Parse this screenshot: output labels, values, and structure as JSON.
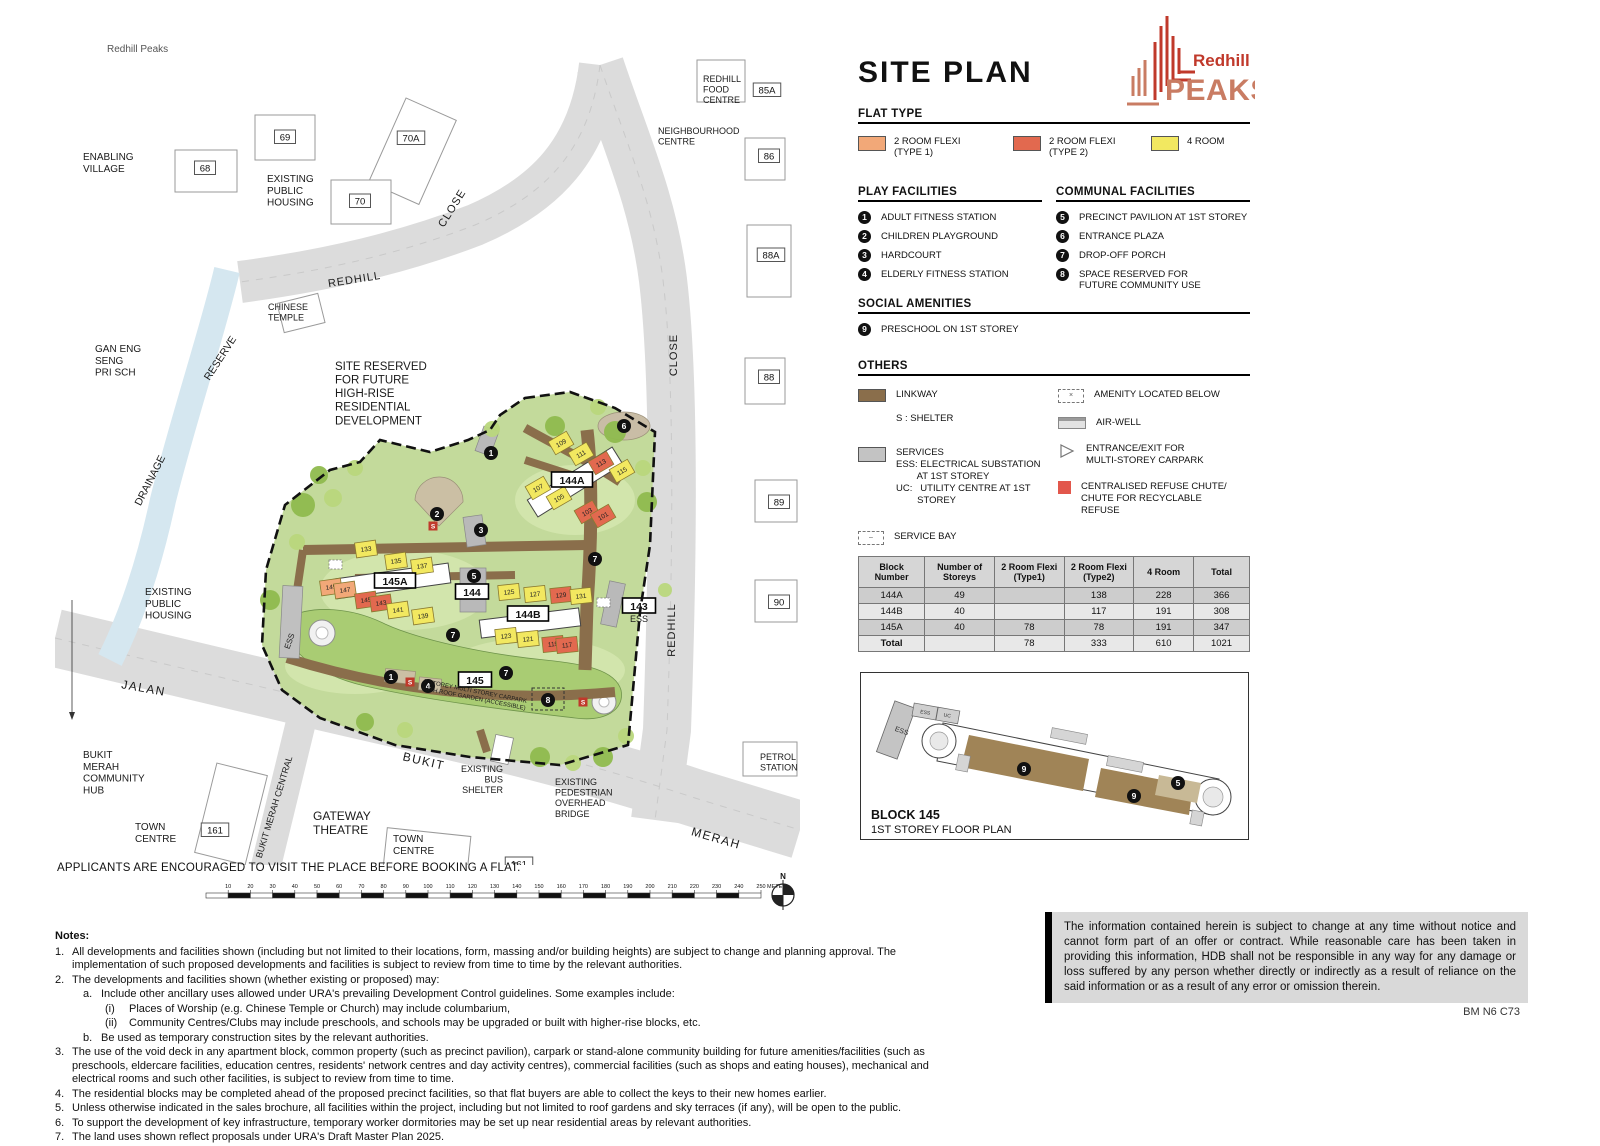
{
  "header": {
    "title": "SITE PLAN",
    "logo_top": "Redhill",
    "logo_bottom": "PEAKS",
    "logo_colors": {
      "red": "#C0392B",
      "salmon": "#C97C63"
    }
  },
  "flat_type": {
    "title": "FLAT TYPE",
    "items": [
      {
        "label": "2 ROOM FLEXI\n(TYPE 1)",
        "color": "#F2A878"
      },
      {
        "label": "2 ROOM FLEXI\n(TYPE 2)",
        "color": "#E2694F"
      },
      {
        "label": "4 ROOM",
        "color": "#F2E860"
      }
    ]
  },
  "play_facilities": {
    "title": "PLAY FACILITIES",
    "items": [
      {
        "num": "1",
        "label": "ADULT FITNESS STATION"
      },
      {
        "num": "2",
        "label": "CHILDREN PLAYGROUND"
      },
      {
        "num": "3",
        "label": "HARDCOURT"
      },
      {
        "num": "4",
        "label": "ELDERLY FITNESS STATION"
      }
    ]
  },
  "communal_facilities": {
    "title": "COMMUNAL FACILITIES",
    "items": [
      {
        "num": "5",
        "label": "PRECINCT PAVILION AT 1ST STOREY"
      },
      {
        "num": "6",
        "label": "ENTRANCE PLAZA"
      },
      {
        "num": "7",
        "label": "DROP-OFF PORCH"
      },
      {
        "num": "8",
        "label": "SPACE RESERVED FOR\nFUTURE COMMUNITY USE"
      }
    ]
  },
  "social_amenities": {
    "title": "SOCIAL AMENITIES",
    "items": [
      {
        "num": "9",
        "label": "PRESCHOOL ON 1ST STOREY"
      }
    ]
  },
  "others": {
    "title": "OTHERS",
    "linkway_label": "LINKWAY",
    "shelter_note": "S : SHELTER",
    "services_label": "SERVICES",
    "services_note": "ESS: ELECTRICAL SUBSTATION\n        AT 1ST STOREY\nUC:   UTILITY CENTRE AT 1ST\n        STOREY",
    "service_bay_label": "SERVICE BAY",
    "amenity_below_label": "AMENITY LOCATED BELOW",
    "air_well_label": "AIR-WELL",
    "carpark_entrance_label": "ENTRANCE/EXIT FOR\nMULTI-STOREY CARPARK",
    "refuse_label": "CENTRALISED REFUSE CHUTE/\nCHUTE FOR RECYCLABLE\nREFUSE",
    "colors": {
      "linkway": "#8A6E4B",
      "services": "#C3C3C3",
      "air_well": "#DFDFDF",
      "refuse": "#E2574C"
    }
  },
  "units_table": {
    "headers": [
      "Block\nNumber",
      "Number of\nStoreys",
      "2 Room Flexi\n(Type1)",
      "2 Room Flexi\n(Type2)",
      "4 Room",
      "Total"
    ],
    "rows": [
      [
        "144A",
        "49",
        "",
        "138",
        "228",
        "366"
      ],
      [
        "144B",
        "40",
        "",
        "117",
        "191",
        "308"
      ],
      [
        "145A",
        "40",
        "78",
        "78",
        "191",
        "347"
      ],
      [
        "Total",
        "",
        "78",
        "333",
        "610",
        "1021"
      ]
    ]
  },
  "floorplan": {
    "title": "BLOCK  145",
    "subtitle": "1ST STOREY FLOOR PLAN",
    "badges": [
      {
        "t": "9",
        "x": 163,
        "y": 96
      },
      {
        "t": "9",
        "x": 273,
        "y": 123
      },
      {
        "t": "5",
        "x": 317,
        "y": 110
      }
    ],
    "area_labels": [
      {
        "t": "ESS",
        "x": 40,
        "y": 60,
        "r": 20,
        "s": 7
      },
      {
        "t": "ESS",
        "x": 64,
        "y": 41,
        "r": 10,
        "s": 5
      },
      {
        "t": "UC",
        "x": 86,
        "y": 44,
        "r": 10,
        "s": 5
      }
    ]
  },
  "map": {
    "labels": [
      {
        "t": "Redhill Peaks",
        "x": 52,
        "y": 22,
        "s": 10,
        "c": "#555"
      },
      {
        "t": "ENABLING\nVILLAGE",
        "x": 28,
        "y": 130,
        "s": 10
      },
      {
        "t": "EXISTING\nPUBLIC\nHOUSING",
        "x": 212,
        "y": 152,
        "s": 10
      },
      {
        "t": "CHINESE\nTEMPLE",
        "x": 213,
        "y": 280,
        "s": 9
      },
      {
        "t": "GAN ENG\nSENG\nPRI SCH",
        "x": 40,
        "y": 322,
        "s": 10
      },
      {
        "t": "RESERVE",
        "x": 168,
        "y": 330,
        "s": 10.5,
        "r": -57,
        "a": "m"
      },
      {
        "t": "DRAINAGE",
        "x": 98,
        "y": 452,
        "s": 10.5,
        "r": -63,
        "a": "m"
      },
      {
        "t": "REDHILL",
        "x": 300,
        "y": 253,
        "s": 11,
        "r": -9,
        "a": "m",
        "ls": 1
      },
      {
        "t": "CLOSE",
        "x": 400,
        "y": 180,
        "s": 11,
        "r": -58,
        "a": "m",
        "ls": 1
      },
      {
        "t": "CLOSE",
        "x": 622,
        "y": 325,
        "s": 11,
        "r": -90,
        "a": "m",
        "ls": 1
      },
      {
        "t": "REDHILL",
        "x": 620,
        "y": 600,
        "s": 11,
        "r": -90,
        "a": "m",
        "ls": 1
      },
      {
        "t": "JALAN",
        "x": 88,
        "y": 662,
        "s": 12,
        "r": 10,
        "a": "m",
        "ls": 1.5
      },
      {
        "t": "BUKIT",
        "x": 368,
        "y": 735,
        "s": 12,
        "r": 13,
        "a": "m",
        "ls": 1.5
      },
      {
        "t": "MERAH",
        "x": 660,
        "y": 812,
        "s": 12,
        "r": 16,
        "a": "m",
        "ls": 1.5
      },
      {
        "t": "BUKIT MERAH CENTRAL",
        "x": 222,
        "y": 778,
        "s": 9,
        "r": -73,
        "a": "m"
      },
      {
        "t": "SITE RESERVED\nFOR  FUTURE\nHIGH-RISE\nRESIDENTIAL\nDEVELOPMENT",
        "x": 280,
        "y": 340,
        "s": 11.5
      },
      {
        "t": "REDHILL\nFOOD\nCENTRE",
        "x": 648,
        "y": 52,
        "s": 9
      },
      {
        "t": "NEIGHBOURHOOD\nCENTRE",
        "x": 603,
        "y": 104,
        "s": 9
      },
      {
        "t": "PETROL\nSTATION",
        "x": 705,
        "y": 730,
        "s": 9
      },
      {
        "t": "BUKIT\nMERAH\nCOMMUNITY\nHUB",
        "x": 28,
        "y": 728,
        "s": 10
      },
      {
        "t": "TOWN\nCENTRE",
        "x": 80,
        "y": 800,
        "s": 10
      },
      {
        "t": "TOWN\nCENTRE",
        "x": 338,
        "y": 812,
        "s": 10
      },
      {
        "t": "GATEWAY\nTHEATRE",
        "x": 258,
        "y": 790,
        "s": 12
      },
      {
        "t": "EXISTING\nBUS\nSHELTER",
        "x": 448,
        "y": 742,
        "s": 9,
        "a": "e"
      },
      {
        "t": "EXISTING\nPEDESTRIAN\nOVERHEAD\nBRIDGE",
        "x": 500,
        "y": 755,
        "s": 9
      },
      {
        "t": "EXISTING\nPUBLIC\nHOUSING",
        "x": 90,
        "y": 565,
        "s": 10
      },
      {
        "t": "7 STOREY MULTI STOREY CARPARK\nWITH ROOF GARDEN (ACCESSIBLE)",
        "x": 420,
        "y": 663,
        "s": 6,
        "r": 11,
        "a": "m"
      },
      {
        "t": "ESS",
        "x": 237,
        "y": 612,
        "s": 8,
        "r": -70,
        "a": "m"
      },
      {
        "t": "ESS",
        "x": 584,
        "y": 592,
        "s": 9,
        "a": "m"
      }
    ],
    "number_boxes": [
      {
        "t": "68",
        "x": 150,
        "y": 138
      },
      {
        "t": "69",
        "x": 230,
        "y": 107
      },
      {
        "t": "70A",
        "x": 356,
        "y": 108
      },
      {
        "t": "70",
        "x": 305,
        "y": 171
      },
      {
        "t": "85A",
        "x": 712,
        "y": 60
      },
      {
        "t": "86",
        "x": 714,
        "y": 126
      },
      {
        "t": "88A",
        "x": 716,
        "y": 225
      },
      {
        "t": "88",
        "x": 714,
        "y": 347
      },
      {
        "t": "89",
        "x": 724,
        "y": 472
      },
      {
        "t": "90",
        "x": 724,
        "y": 572
      },
      {
        "t": "161",
        "x": 160,
        "y": 800
      },
      {
        "t": "161",
        "x": 464,
        "y": 834
      }
    ],
    "block_boxes": [
      {
        "t": "144A",
        "x": 517,
        "y": 450
      },
      {
        "t": "145A",
        "x": 340,
        "y": 551
      },
      {
        "t": "144B",
        "x": 473,
        "y": 584
      },
      {
        "t": "144",
        "x": 417,
        "y": 562
      },
      {
        "t": "145",
        "x": 420,
        "y": 650
      },
      {
        "t": "143",
        "x": 584,
        "y": 576
      }
    ],
    "units": [
      {
        "t": "109",
        "x": 506,
        "y": 413,
        "r": -30,
        "c": "y"
      },
      {
        "t": "111",
        "x": 526,
        "y": 424,
        "r": -30,
        "c": "y"
      },
      {
        "t": "113",
        "x": 546,
        "y": 433,
        "r": -30,
        "c": "r"
      },
      {
        "t": "115",
        "x": 567,
        "y": 441,
        "r": -30,
        "c": "y"
      },
      {
        "t": "107",
        "x": 483,
        "y": 458,
        "r": -30,
        "c": "y"
      },
      {
        "t": "105",
        "x": 504,
        "y": 468,
        "r": -30,
        "c": "y"
      },
      {
        "t": "103",
        "x": 532,
        "y": 482,
        "r": -30,
        "c": "r"
      },
      {
        "t": "101",
        "x": 548,
        "y": 486,
        "r": -30,
        "c": "r"
      },
      {
        "t": "133",
        "x": 311,
        "y": 519,
        "r": -8,
        "c": "y"
      },
      {
        "t": "135",
        "x": 341,
        "y": 531,
        "r": -8,
        "c": "y"
      },
      {
        "t": "137",
        "x": 367,
        "y": 536,
        "r": -8,
        "c": "y"
      },
      {
        "t": "149",
        "x": 276,
        "y": 557,
        "r": -8,
        "c": "o"
      },
      {
        "t": "147",
        "x": 290,
        "y": 560,
        "r": -8,
        "c": "o"
      },
      {
        "t": "145",
        "x": 311,
        "y": 570,
        "r": -8,
        "c": "r"
      },
      {
        "t": "143",
        "x": 326,
        "y": 573,
        "r": -8,
        "c": "r"
      },
      {
        "t": "141",
        "x": 343,
        "y": 580,
        "r": -8,
        "c": "y"
      },
      {
        "t": "139",
        "x": 368,
        "y": 586,
        "r": -8,
        "c": "y"
      },
      {
        "t": "125",
        "x": 454,
        "y": 562,
        "r": -6,
        "c": "y"
      },
      {
        "t": "127",
        "x": 480,
        "y": 564,
        "r": -6,
        "c": "y"
      },
      {
        "t": "129",
        "x": 506,
        "y": 565,
        "r": -6,
        "c": "r"
      },
      {
        "t": "131",
        "x": 526,
        "y": 566,
        "r": -6,
        "c": "y"
      },
      {
        "t": "123",
        "x": 451,
        "y": 606,
        "r": -6,
        "c": "y"
      },
      {
        "t": "121",
        "x": 473,
        "y": 609,
        "r": -6,
        "c": "y"
      },
      {
        "t": "119",
        "x": 498,
        "y": 614,
        "r": -6,
        "c": "r"
      },
      {
        "t": "117",
        "x": 512,
        "y": 615,
        "r": -6,
        "c": "r"
      }
    ],
    "badges": [
      {
        "t": "1",
        "x": 436,
        "y": 423
      },
      {
        "t": "2",
        "x": 382,
        "y": 484
      },
      {
        "t": "3",
        "x": 426,
        "y": 500
      },
      {
        "t": "5",
        "x": 419,
        "y": 546
      },
      {
        "t": "6",
        "x": 569,
        "y": 396
      },
      {
        "t": "7",
        "x": 540,
        "y": 529
      },
      {
        "t": "7",
        "x": 398,
        "y": 605
      },
      {
        "t": "7",
        "x": 451,
        "y": 643
      },
      {
        "t": "1",
        "x": 336,
        "y": 647
      },
      {
        "t": "4",
        "x": 373,
        "y": 656
      },
      {
        "t": "8",
        "x": 493,
        "y": 670
      }
    ],
    "shelters": [
      {
        "x": 378,
        "y": 496
      },
      {
        "x": 355,
        "y": 652
      },
      {
        "x": 528,
        "y": 672
      }
    ],
    "trees": [
      {
        "x": 248,
        "y": 475,
        "r": 12,
        "sh": "d"
      },
      {
        "x": 278,
        "y": 468,
        "r": 9,
        "sh": "l"
      },
      {
        "x": 560,
        "y": 402,
        "r": 11,
        "sh": "d"
      },
      {
        "x": 588,
        "y": 438,
        "r": 8,
        "sh": "l"
      },
      {
        "x": 592,
        "y": 472,
        "r": 10,
        "sh": "d"
      },
      {
        "x": 242,
        "y": 512,
        "r": 8,
        "sh": "l"
      },
      {
        "x": 215,
        "y": 570,
        "r": 10,
        "sh": "d"
      },
      {
        "x": 485,
        "y": 727,
        "r": 10,
        "sh": "d"
      },
      {
        "x": 518,
        "y": 733,
        "r": 8,
        "sh": "l"
      },
      {
        "x": 548,
        "y": 727,
        "r": 10,
        "sh": "d"
      },
      {
        "x": 571,
        "y": 706,
        "r": 8,
        "sh": "l"
      },
      {
        "x": 437,
        "y": 399,
        "r": 8,
        "sh": "l"
      },
      {
        "x": 500,
        "y": 396,
        "r": 10,
        "sh": "d"
      },
      {
        "x": 543,
        "y": 377,
        "r": 8,
        "sh": "l"
      },
      {
        "x": 300,
        "y": 438,
        "r": 8,
        "sh": "l"
      },
      {
        "x": 264,
        "y": 445,
        "r": 9,
        "sh": "d"
      },
      {
        "x": 610,
        "y": 560,
        "r": 7,
        "sh": "l"
      },
      {
        "x": 350,
        "y": 700,
        "r": 8,
        "sh": "l"
      },
      {
        "x": 310,
        "y": 692,
        "r": 9,
        "sh": "d"
      }
    ]
  },
  "scale": {
    "step": 10,
    "count": 25,
    "unit": "METERS",
    "north": "N"
  },
  "footer": {
    "applicants": "APPLICANTS ARE ENCOURAGED TO VISIT THE PLACE BEFORE BOOKING A FLAT.",
    "notes_title": "Notes:",
    "notes": [
      {
        "m": "1.",
        "i": 0,
        "t": "All developments and facilities shown (including but not limited to their locations, form, massing and/or building heights) are subject to change and planning approval. The implementation of such proposed developments and facilities is subject to review from time to time by the relevant authorities."
      },
      {
        "m": "2.",
        "i": 0,
        "t": "The developments and facilities shown (whether existing or proposed) may:"
      },
      {
        "m": "a.",
        "i": 1,
        "t": "Include other ancillary uses allowed under URA's prevailing Development Control guidelines. Some examples include:"
      },
      {
        "m": "(i)",
        "i": 2,
        "t": "Places of Worship (e.g. Chinese Temple or Church) may include columbarium,"
      },
      {
        "m": "(ii)",
        "i": 2,
        "t": "Community Centres/Clubs may include preschools, and schools may be upgraded or built with higher-rise blocks, etc."
      },
      {
        "m": "b.",
        "i": 1,
        "t": "Be used as temporary construction sites by the relevant authorities."
      },
      {
        "m": "3.",
        "i": 0,
        "t": "The use of the void deck in any apartment block, common property (such as precinct pavilion), carpark or stand-alone community building for future amenities/facilities (such as preschools, eldercare facilities, education centres, residents' network centres and day activity centres), commercial facilities (such as shops and eating houses), mechanical and electrical rooms and such other facilities, is subject to review from time to time."
      },
      {
        "m": "4.",
        "i": 0,
        "t": "The residential blocks may be completed ahead of the proposed precinct facilities, so that flat buyers are able to collect the keys to their new homes earlier."
      },
      {
        "m": "5.",
        "i": 0,
        "t": "Unless otherwise indicated in the sales brochure, all facilities within the project, including but not limited to roof gardens and sky terraces (if any), will be open to the public."
      },
      {
        "m": "6.",
        "i": 0,
        "t": "To support the development of key infrastructure, temporary worker dormitories may be set up near residential areas by relevant authorities."
      },
      {
        "m": "7.",
        "i": 0,
        "t": "The land uses shown reflect proposals under URA's Draft Master Plan 2025."
      }
    ],
    "disclaimer": "The information contained herein is subject to change at any time without notice and cannot form part of an offer or contract. While reasonable care has been taken in providing this information, HDB shall not be responsible in any way for any damage or loss suffered by any person whether directly or indirectly as a result of reliance on the said information or as a result of any error or omission therein.",
    "code": "BM N6 C73"
  }
}
